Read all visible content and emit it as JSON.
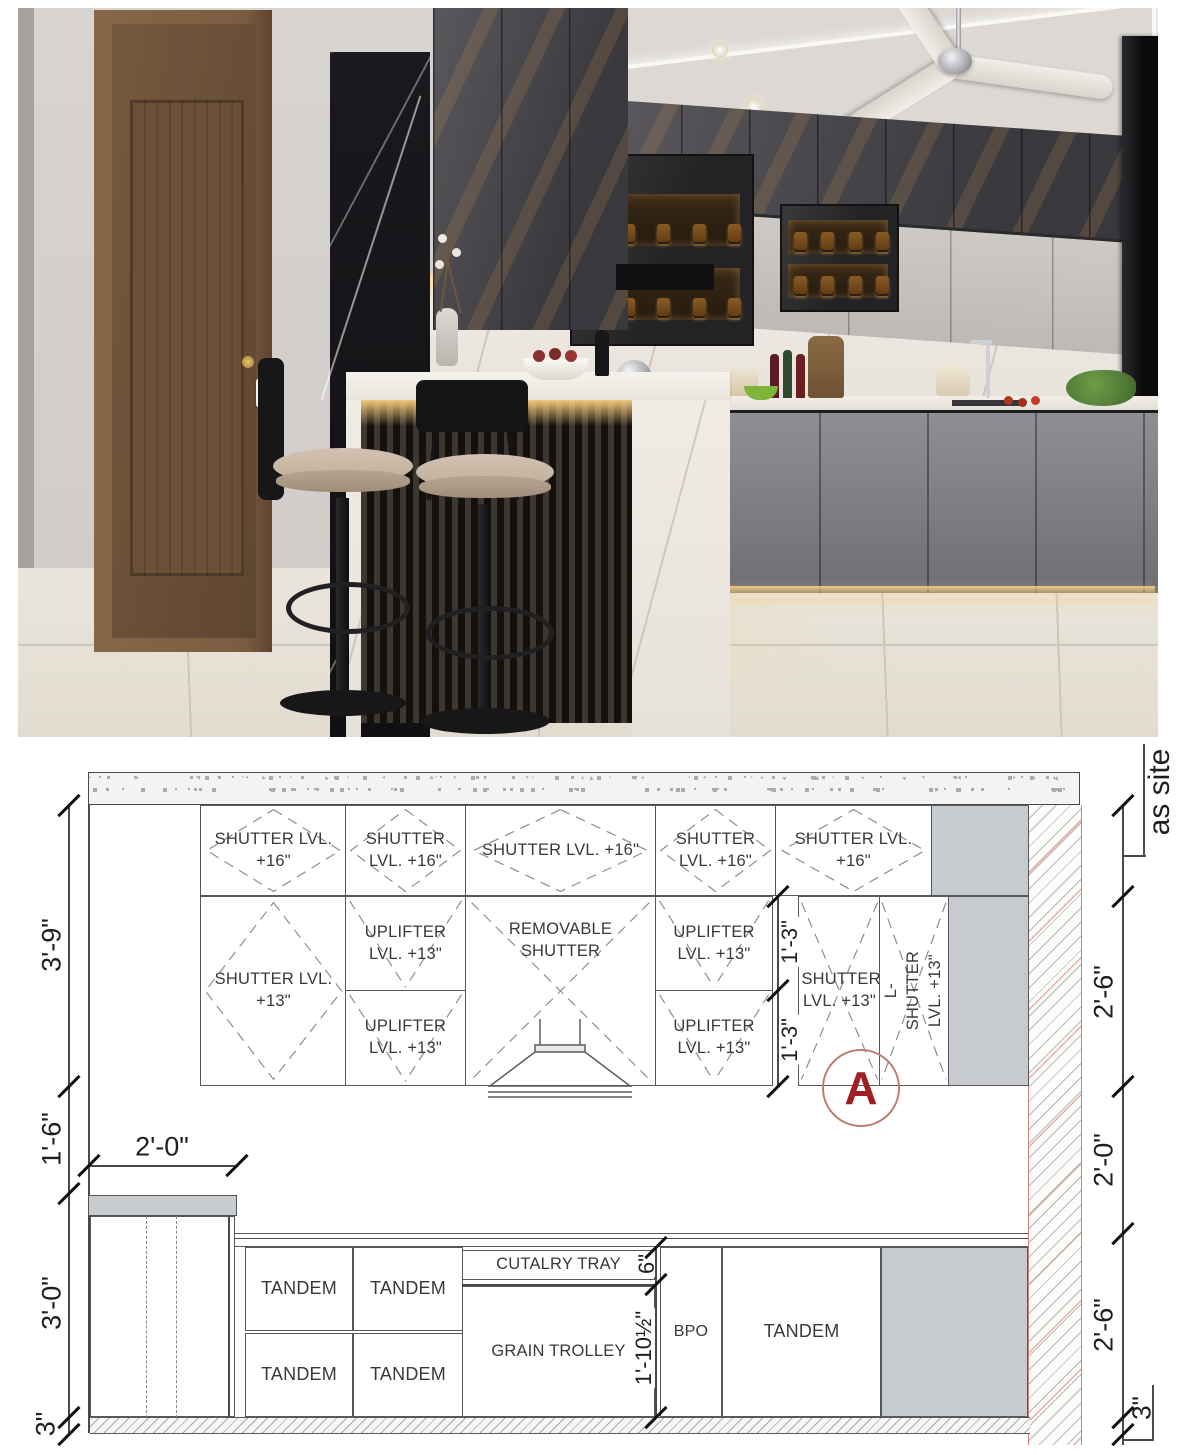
{
  "photo": {
    "scene": "modern kitchen interior render",
    "palette": {
      "cabinet_dark": "#4a4a4e",
      "cabinet_light": "#c9c6c2",
      "marble_white": "#ece7e0",
      "marble_black": "#141417",
      "door_wood": "#73563c",
      "warm_light": "#f5d9a8",
      "floor": "#e7e2d8",
      "seat_cushion": "#cbb9a8"
    }
  },
  "drawing": {
    "upper": {
      "top_row": [
        "SHUTTER LVL. +16\"",
        "SHUTTER LVL. +16\"",
        "SHUTTER LVL. +16\"",
        "SHUTTER LVL. +16\"",
        "SHUTTER LVL. +16\""
      ],
      "shutter13_left": "SHUTTER LVL. +13\"",
      "uplifters": [
        "UPLIFTER LVL. +13\"",
        "UPLIFTER LVL. +13\"",
        "UPLIFTER LVL. +13\"",
        "UPLIFTER LVL. +13\""
      ],
      "removable": "REMOVABLE SHUTTER",
      "shutter13_right": "SHUTTER LVL. +13\"",
      "l_shutter": "L-SHUTTER LVL. +13\""
    },
    "base": {
      "tandem": [
        "TANDEM",
        "TANDEM",
        "TANDEM",
        "TANDEM",
        "TANDEM"
      ],
      "cutlery": "CUTALRY TRAY",
      "grain": "GRAIN TROLLEY",
      "bpo": "BPO"
    },
    "dims": {
      "left_upper": "3'-9\"",
      "left_gap": "1'-6\"",
      "left_base": "3'-0\"",
      "left_skirt": "3\"",
      "top_tall_unit": "2'-0\"",
      "right_as_site": "as site",
      "right_upper": "2'-6\"",
      "right_gap": "2'-0\"",
      "right_base": "2'-6\"",
      "right_skirt": "3\"",
      "inner_13": [
        "1'-3\"",
        "1'-3\""
      ],
      "inner_6": "6\"",
      "inner_grain": "1'-10½\""
    },
    "section_marker": "A",
    "colors": {
      "marker_red": "#9e2023",
      "marker_ring": "#bd7b73",
      "line": "#4a4a4c",
      "fill_gray": "#c7cbcd",
      "hatch_red": "#cf8276"
    }
  }
}
